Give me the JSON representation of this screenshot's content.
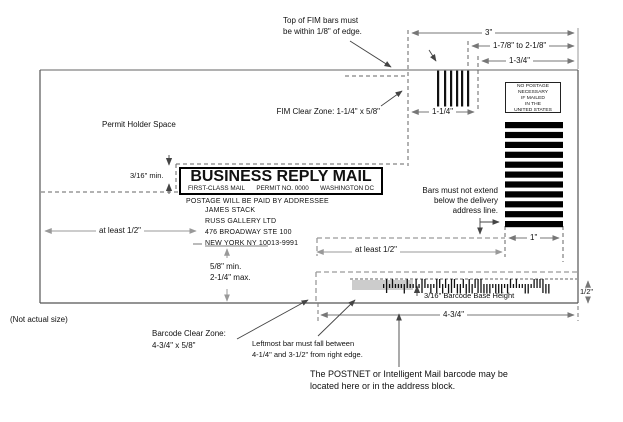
{
  "diagram": {
    "annotations": {
      "top_fim_note": "Top of FIM bars must\nbe within 1/8\" of edge.",
      "fim_clear_zone": "FIM Clear Zone: 1-1/4\" x 5/8\"",
      "permit_holder_space": "Permit Holder Space",
      "bars_note": "Bars must not extend\nbelow the delivery\naddress line.",
      "barcode_base_height": "3/16\" Barcode Base Height",
      "not_actual_size": "(Not actual size)",
      "barcode_clear_zone": "Barcode Clear Zone:\n4-3/4\" x 5/8\"",
      "leftmost_bar_note": "Leftmost bar must fall between\n4-1/4\" and 3-1/2\" from right edge.",
      "postnet_note": "The POSTNET or Intelligent Mail barcode may be\nlocated here or in the address block."
    },
    "dimensions": {
      "three_inch": "3\"",
      "fim_range": "1-7/8\" to 2-1/8\"",
      "one_three_quarter": "1-3/4\"",
      "one_one_quarter": "1-1/4\"",
      "min_three_sixteenth": "3/16\" min.",
      "at_least_half_left": "at least 1/2\"",
      "address_clearance": "5/8\" min.\n2-1/4\" max.",
      "one_inch": "1\"",
      "at_least_half_mid": "at least 1/2\"",
      "half_inch": "1/2\"",
      "four_three_quarter": "4-3/4\""
    },
    "brm": {
      "title": "BUSINESS REPLY MAIL",
      "mail_class": "FIRST-CLASS MAIL",
      "permit": "PERMIT NO. 0000",
      "city": "WASHINGTON DC",
      "postage_line": "POSTAGE WILL BE PAID BY ADDRESSEE"
    },
    "address": [
      "JAMES STACK",
      "RUSS GALLERY LTD",
      "476 BROADWAY STE 100",
      "NEW YORK NY 10013-9991"
    ],
    "no_postage": "NO POSTAGE\nNECESSARY\nIF MAILED\nIN THE\nUNITED STATES"
  }
}
